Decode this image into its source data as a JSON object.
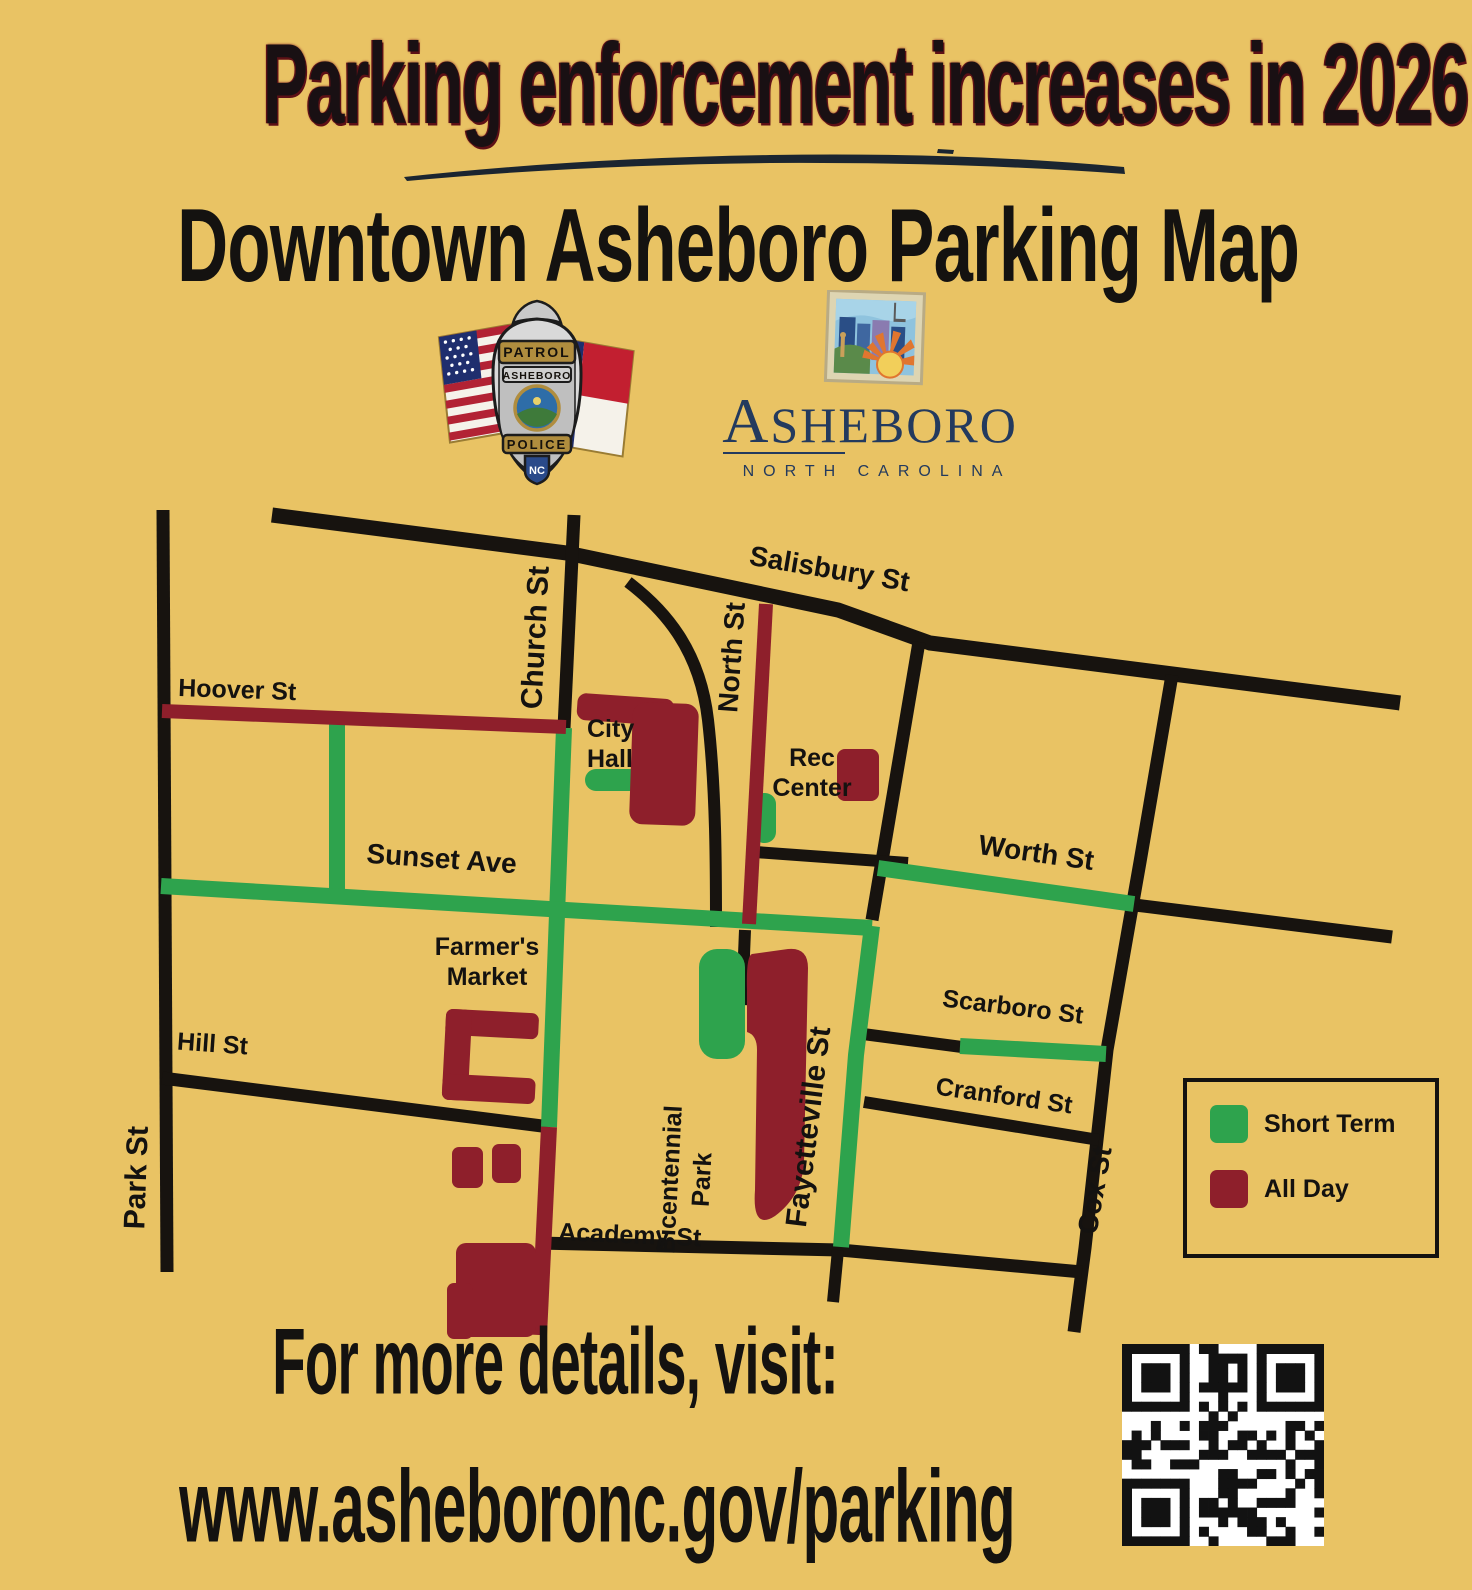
{
  "title": "Parking enforcement increases in 2026!",
  "subtitle": "Downtown Asheboro Parking Map",
  "badge": {
    "patrol": "PATROL",
    "city": "ASHEBORO",
    "police": "POLICE",
    "nc_bottom": "NC",
    "nc_flag": "NC"
  },
  "city_logo": {
    "initial": "A",
    "rest": "SHEBORO",
    "tagline": "NORTH CAROLINA"
  },
  "map": {
    "labels": {
      "salisbury": "Salisbury St",
      "church": "Church St",
      "north": "North St",
      "hoover": "Hoover St",
      "sunset": "Sunset Ave",
      "worth": "Worth St",
      "scarboro": "Scarboro St",
      "cranford": "Cranford St",
      "hill": "Hill St",
      "academy": "Academy St",
      "park": "Park St",
      "fayetteville": "Fayetteville St",
      "cox": "Cox St",
      "city_hall_1": "City",
      "city_hall_2": "Hall",
      "rec_center_1": "Rec",
      "rec_center_2": "Center",
      "farmers_market_1": "Farmer's",
      "farmers_market_2": "Market",
      "bicentennial_1": "Bicentennial",
      "bicentennial_2": "Park"
    }
  },
  "legend": {
    "short_term": "Short Term",
    "all_day": "All Day"
  },
  "footer": {
    "line1": "For more details, visit:",
    "line2": "www.asheboronc.gov/parking"
  },
  "colors": {
    "background": "#e9c364",
    "street_black": "#17130f",
    "short_term_green": "#2ea34d",
    "all_day_red": "#8e1f2b",
    "logo_navy": "#233a5e"
  }
}
